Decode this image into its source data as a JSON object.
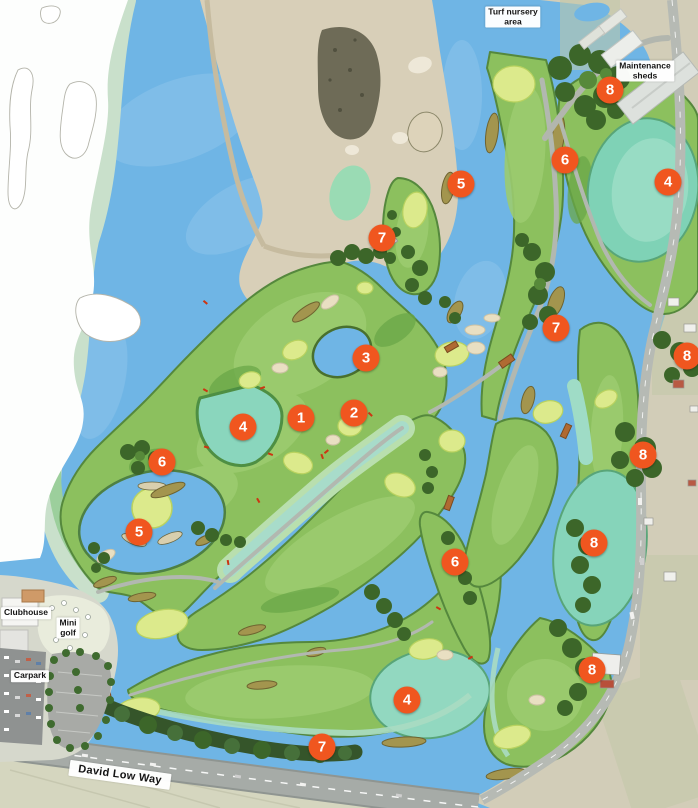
{
  "map": {
    "name": "Golf course masterplan aerial map",
    "colors": {
      "marker_orange": "#f0561f",
      "marker_text": "#ffffff",
      "water_blue": "#6fb5e5",
      "wetland_teal": "#86d4ba",
      "fairway_green": "#8cc05e",
      "putting_green": "#dcea8c",
      "trees_dark": "#3c6629",
      "sand": "#ddd3b5",
      "road_gray": "#a6aba7"
    },
    "markers": [
      {
        "label": "1",
        "x": 301,
        "y": 418
      },
      {
        "label": "2",
        "x": 354,
        "y": 413
      },
      {
        "label": "3",
        "x": 366,
        "y": 358
      },
      {
        "label": "4",
        "x": 243,
        "y": 427
      },
      {
        "label": "5",
        "x": 139,
        "y": 532
      },
      {
        "label": "6",
        "x": 162,
        "y": 462
      },
      {
        "label": "5",
        "x": 461,
        "y": 184
      },
      {
        "label": "7",
        "x": 382,
        "y": 238
      },
      {
        "label": "6",
        "x": 565,
        "y": 160
      },
      {
        "label": "8",
        "x": 610,
        "y": 90
      },
      {
        "label": "4",
        "x": 668,
        "y": 182
      },
      {
        "label": "7",
        "x": 556,
        "y": 328
      },
      {
        "label": "8",
        "x": 687,
        "y": 356
      },
      {
        "label": "8",
        "x": 643,
        "y": 455
      },
      {
        "label": "8",
        "x": 594,
        "y": 543
      },
      {
        "label": "8",
        "x": 592,
        "y": 670
      },
      {
        "label": "6",
        "x": 455,
        "y": 562
      },
      {
        "label": "4",
        "x": 407,
        "y": 700
      },
      {
        "label": "7",
        "x": 322,
        "y": 747
      }
    ],
    "labels": [
      {
        "id": "turf-nursery-area",
        "text": "Turf nursery\narea",
        "x": 513,
        "y": 17,
        "rotate": 0
      },
      {
        "id": "maintenance-sheds",
        "text": "Maintenance\nsheds",
        "x": 645,
        "y": 71,
        "rotate": 0
      },
      {
        "id": "clubhouse",
        "text": "Clubhouse",
        "x": 26,
        "y": 613,
        "rotate": 0
      },
      {
        "id": "mini-golf",
        "text": "Mini\ngolf",
        "x": 68,
        "y": 628,
        "rotate": 0
      },
      {
        "id": "carpark",
        "text": "Carpark",
        "x": 30,
        "y": 676,
        "rotate": 0
      },
      {
        "id": "david-low-way",
        "text": "David Low Way",
        "x": 120,
        "y": 775,
        "rotate": 8,
        "size": "large"
      }
    ]
  }
}
